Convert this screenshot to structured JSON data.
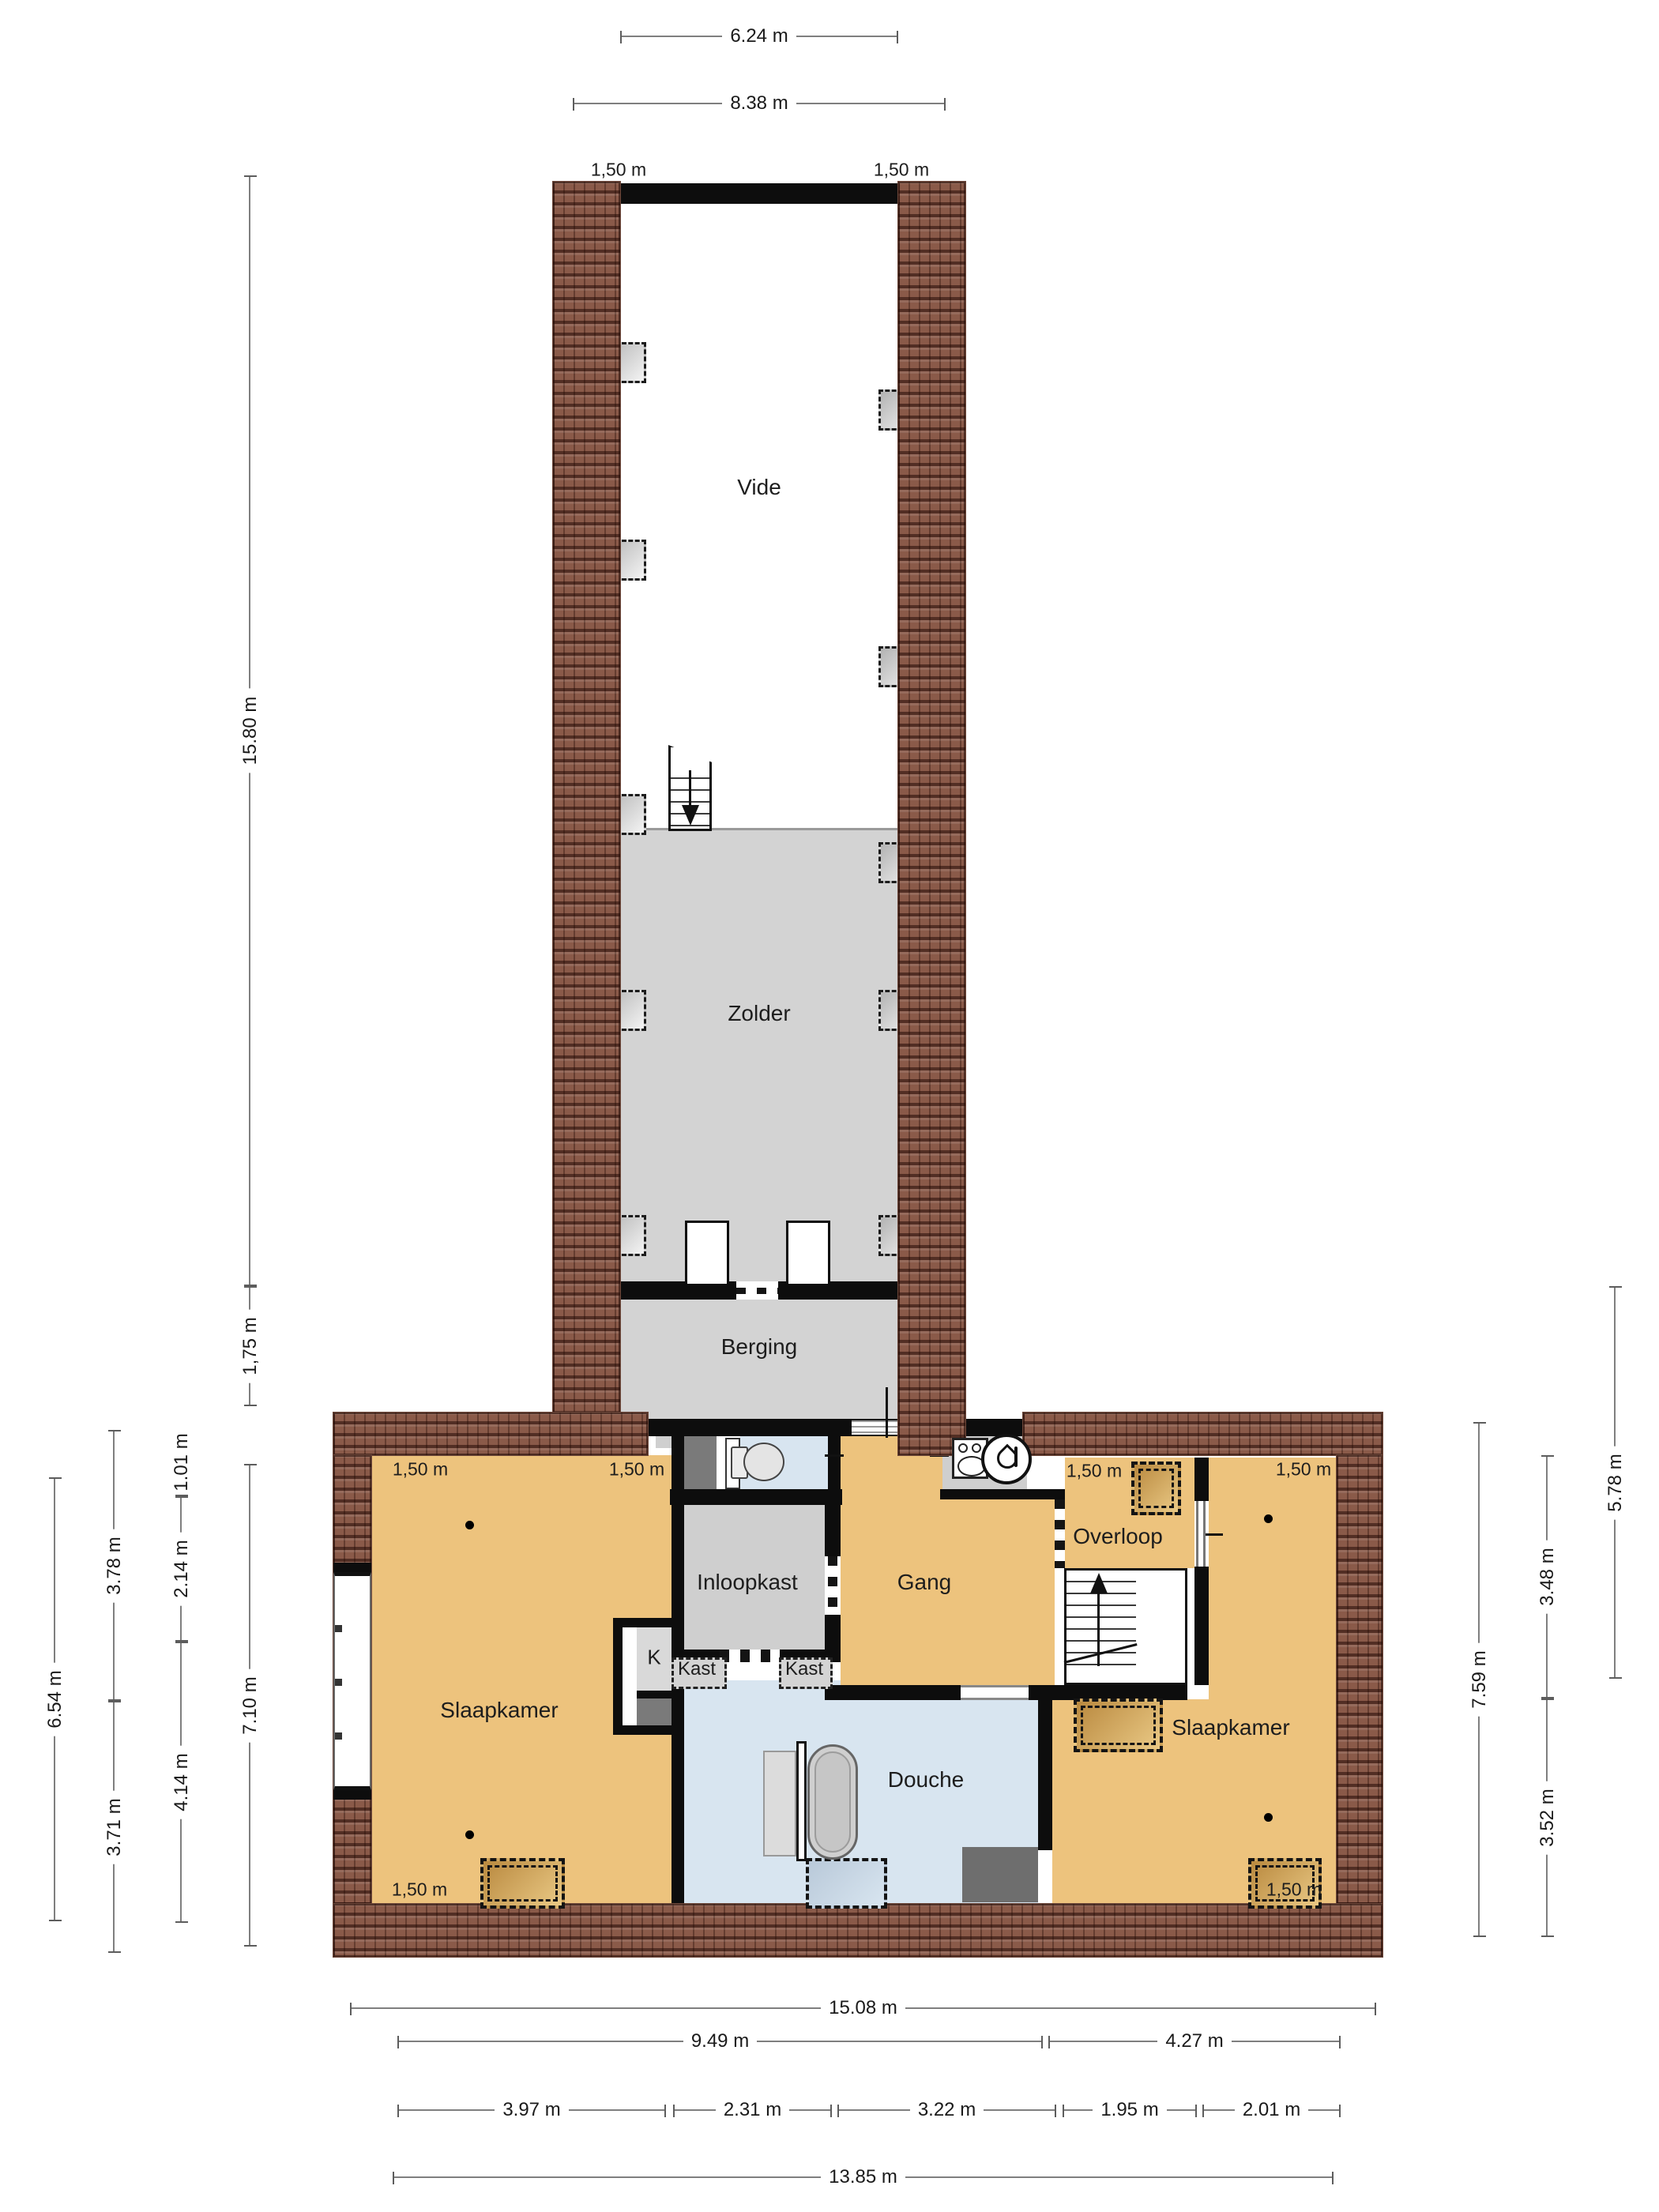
{
  "rooms": {
    "vide": "Vide",
    "zolder": "Zolder",
    "berging": "Berging",
    "slaapkamer_left": "Slaapkamer",
    "inloopkast": "Inloopkast",
    "gang": "Gang",
    "overloop": "Overloop",
    "slaapkamer_right": "Slaapkamer",
    "douche": "Douche",
    "kast_left": "Kast",
    "kast_right": "Kast",
    "k_closet": "K"
  },
  "annotations": {
    "r150": "1,50 m"
  },
  "dims": {
    "top": [
      {
        "label": "6.24 m"
      },
      {
        "label": "8.38 m"
      }
    ],
    "left": [
      {
        "label": "15.80 m"
      },
      {
        "label": "1,75 m"
      },
      {
        "label": "7.10 m"
      },
      {
        "label": "1.01 m"
      },
      {
        "label": "2.14 m"
      },
      {
        "label": "4.14 m"
      },
      {
        "label": "3.78 m"
      },
      {
        "label": "3.71 m"
      },
      {
        "label": "6.54 m"
      }
    ],
    "right": [
      {
        "label": "5.78 m"
      },
      {
        "label": "3.48 m"
      },
      {
        "label": "3.52 m"
      },
      {
        "label": "7.59 m"
      }
    ],
    "bottom": [
      {
        "label": "15.08 m"
      },
      {
        "label": "9.49 m"
      },
      {
        "label": "4.27 m"
      },
      {
        "label": "3.97 m"
      },
      {
        "label": "2.31 m"
      },
      {
        "label": "3.22 m"
      },
      {
        "label": "1.95 m"
      },
      {
        "label": "2.01 m"
      },
      {
        "label": "13.85 m"
      }
    ]
  },
  "colors": {
    "wall": "#0d0d0d",
    "room_orange": "#edc37d",
    "room_gray": "#d3d3d3",
    "room_blue": "#d8e5f0",
    "dark_block": "#777777",
    "roof_brick": "#8a5a49"
  }
}
